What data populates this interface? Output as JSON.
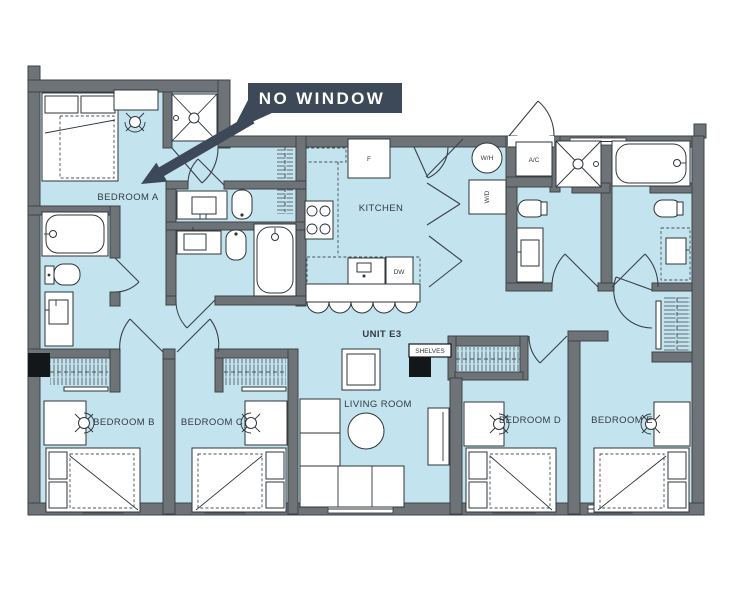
{
  "callout": {
    "text": "NO WINDOW"
  },
  "unit_label": "UNIT E3",
  "rooms": {
    "bedroom_a": "BEDROOM A",
    "bedroom_b": "BEDROOM B",
    "bedroom_c": "BEDROOM C",
    "bedroom_d": "BEDROOM D",
    "bedroom_e": "BEDROOM E",
    "kitchen": "KITCHEN",
    "living_room": "LIVING ROOM"
  },
  "fixtures": {
    "fridge": "F",
    "dishwasher": "DW",
    "water_heater": "W/H",
    "washer_dryer": "W/D",
    "air_conditioner": "A/C",
    "shelves": "SHELVES"
  },
  "colors": {
    "floor": "#c3e4ee",
    "wall": "#6e7377",
    "wall_outline": "#3e4347",
    "line": "#2f353b",
    "label_text": "#343a40",
    "callout_bg": "#3d4959",
    "callout_text": "#ffffff"
  }
}
